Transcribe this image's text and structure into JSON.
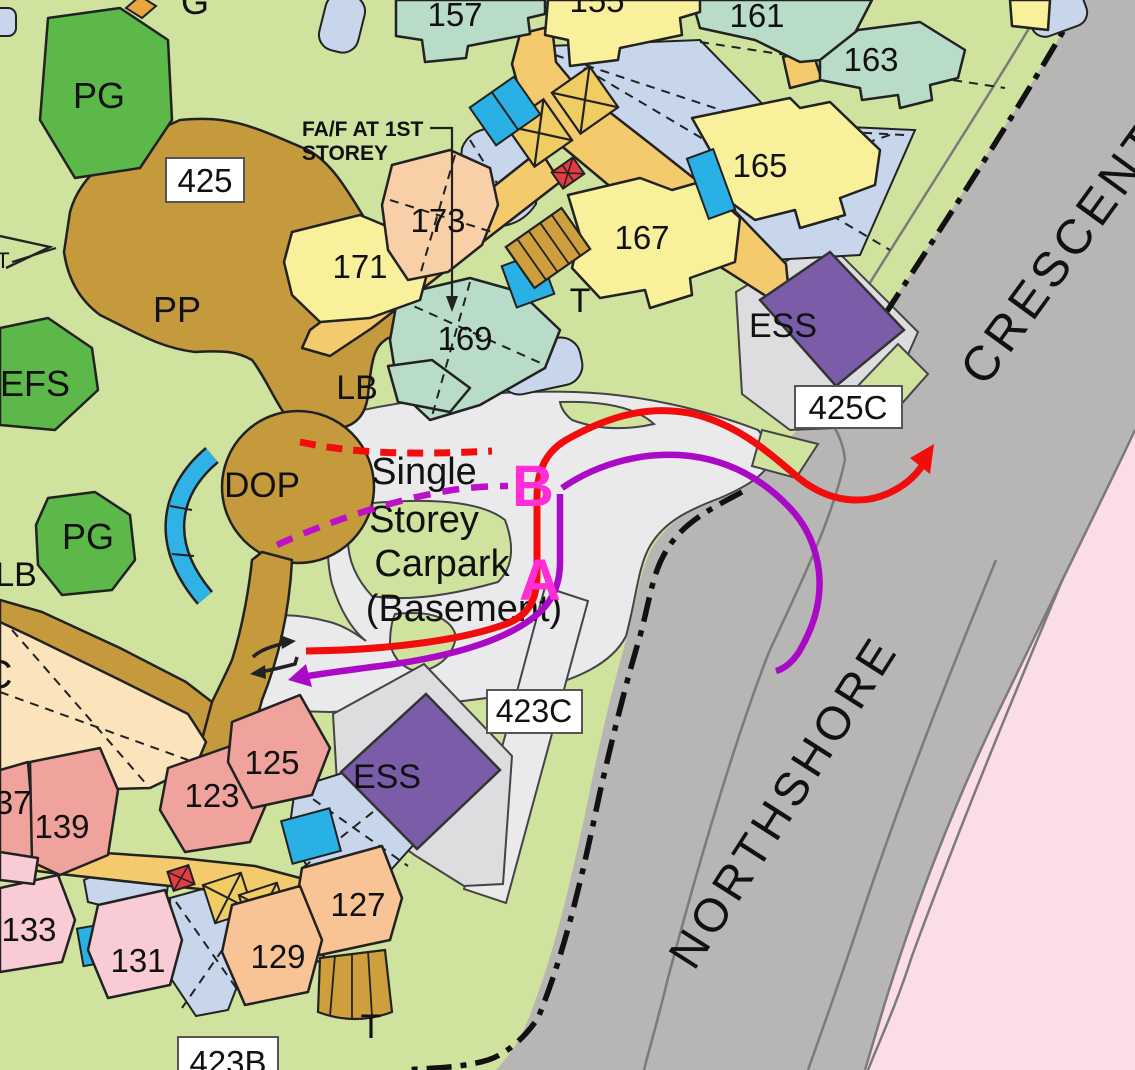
{
  "map": {
    "areas": {
      "pg_top": "PG",
      "pg_mid": "PG",
      "efs": "EFS",
      "pp": "PP",
      "dop": "DOP",
      "lb_top": "LB",
      "lb_left": "LB",
      "ess_top": "ESS",
      "ess_bottom": "ESS",
      "t_top": "T",
      "t_bottom": "T",
      "t_left": "T",
      "c_left": "C",
      "g_top": "G"
    },
    "blocks": {
      "b155": "155",
      "b157": "157",
      "b161": "161",
      "b163": "163",
      "b165": "165",
      "b167": "167",
      "b169": "169",
      "b171": "171",
      "b173": "173",
      "b123": "123",
      "b125": "125",
      "b127": "127",
      "b129": "129",
      "b131": "131",
      "b133": "133",
      "b137": "137",
      "b139": "139"
    },
    "label_boxes": {
      "b425": "425",
      "b425c": "425C",
      "b423c": "423C",
      "b423b": "423B"
    },
    "carpark_text": {
      "line1": "Single",
      "line2": "Storey",
      "line3": "Carpark",
      "line4": "(Basement)"
    },
    "annotation": {
      "line1": "FA/F AT 1ST",
      "line2": "STOREY"
    },
    "roads": {
      "name_main": "NORTHSHORE",
      "name_main2": "CRESCENT"
    },
    "markers": {
      "a": "A",
      "b": "B"
    },
    "colors": {
      "route_red": "#f20d0d",
      "route_purple": "#aa0ac6",
      "marker_magenta": "#ff2ed6",
      "road_gray": "#b8b5b5",
      "carpark_gray": "#eaeaec",
      "background_green": "#cfe29e",
      "ess_purple": "#7b5ca8",
      "residential_pink": "#fbdde9",
      "boundary_black": "#111111"
    }
  }
}
